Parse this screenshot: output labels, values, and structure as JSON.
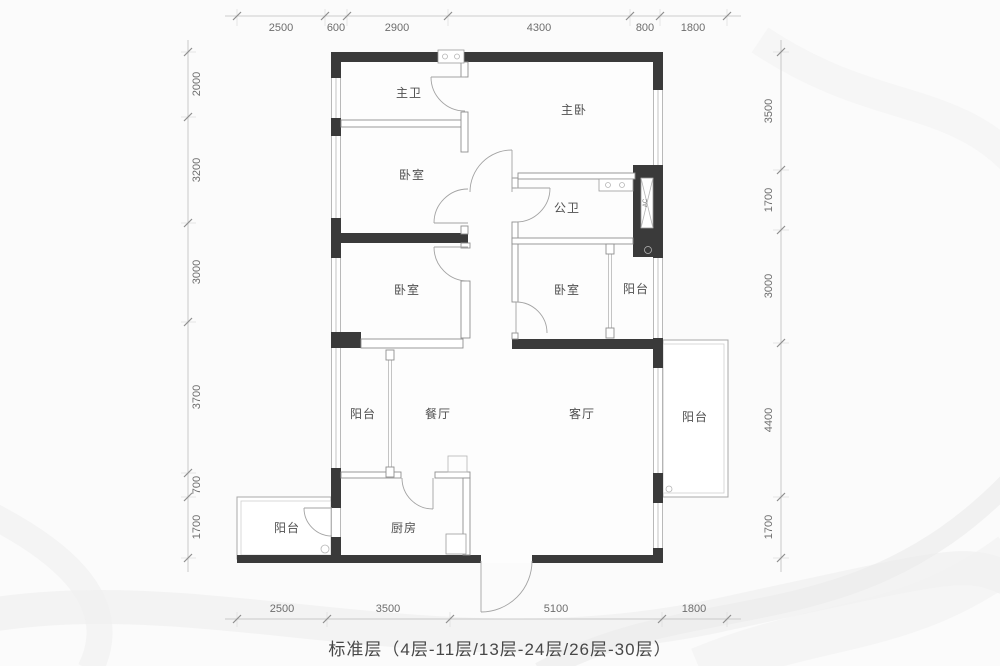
{
  "caption": "标准层（4层-11层/13层-24层/26层-30层）",
  "rooms": {
    "master_bath": "主卫",
    "master_bedroom": "主卧",
    "bedroom_upper_left": "卧室",
    "public_bath": "公卫",
    "bedroom_mid_left": "卧室",
    "bedroom_mid_right": "卧室",
    "balcony_mid_right": "阳台",
    "balcony_dining": "阳台",
    "dining": "餐厅",
    "living": "客厅",
    "balcony_right": "阳台",
    "balcony_bottom_left": "阳台",
    "kitchen": "厨房",
    "ac_label": "AC"
  },
  "dims": {
    "top": [
      "2500",
      "600",
      "2900",
      "4300",
      "800",
      "1800"
    ],
    "bottom": [
      "2500",
      "3500",
      "5100",
      "1800"
    ],
    "left": [
      "2000",
      "3200",
      "3000",
      "3700",
      "700",
      "1700"
    ],
    "right": [
      "3500",
      "1700",
      "3000",
      "4400",
      "1700"
    ]
  },
  "colors": {
    "wall": "#3a3a3a",
    "thin_line": "#8f8f8f",
    "dim_text": "#6d6d6d",
    "room_text": "#4f4f4f",
    "background": "#fbfbfb"
  }
}
